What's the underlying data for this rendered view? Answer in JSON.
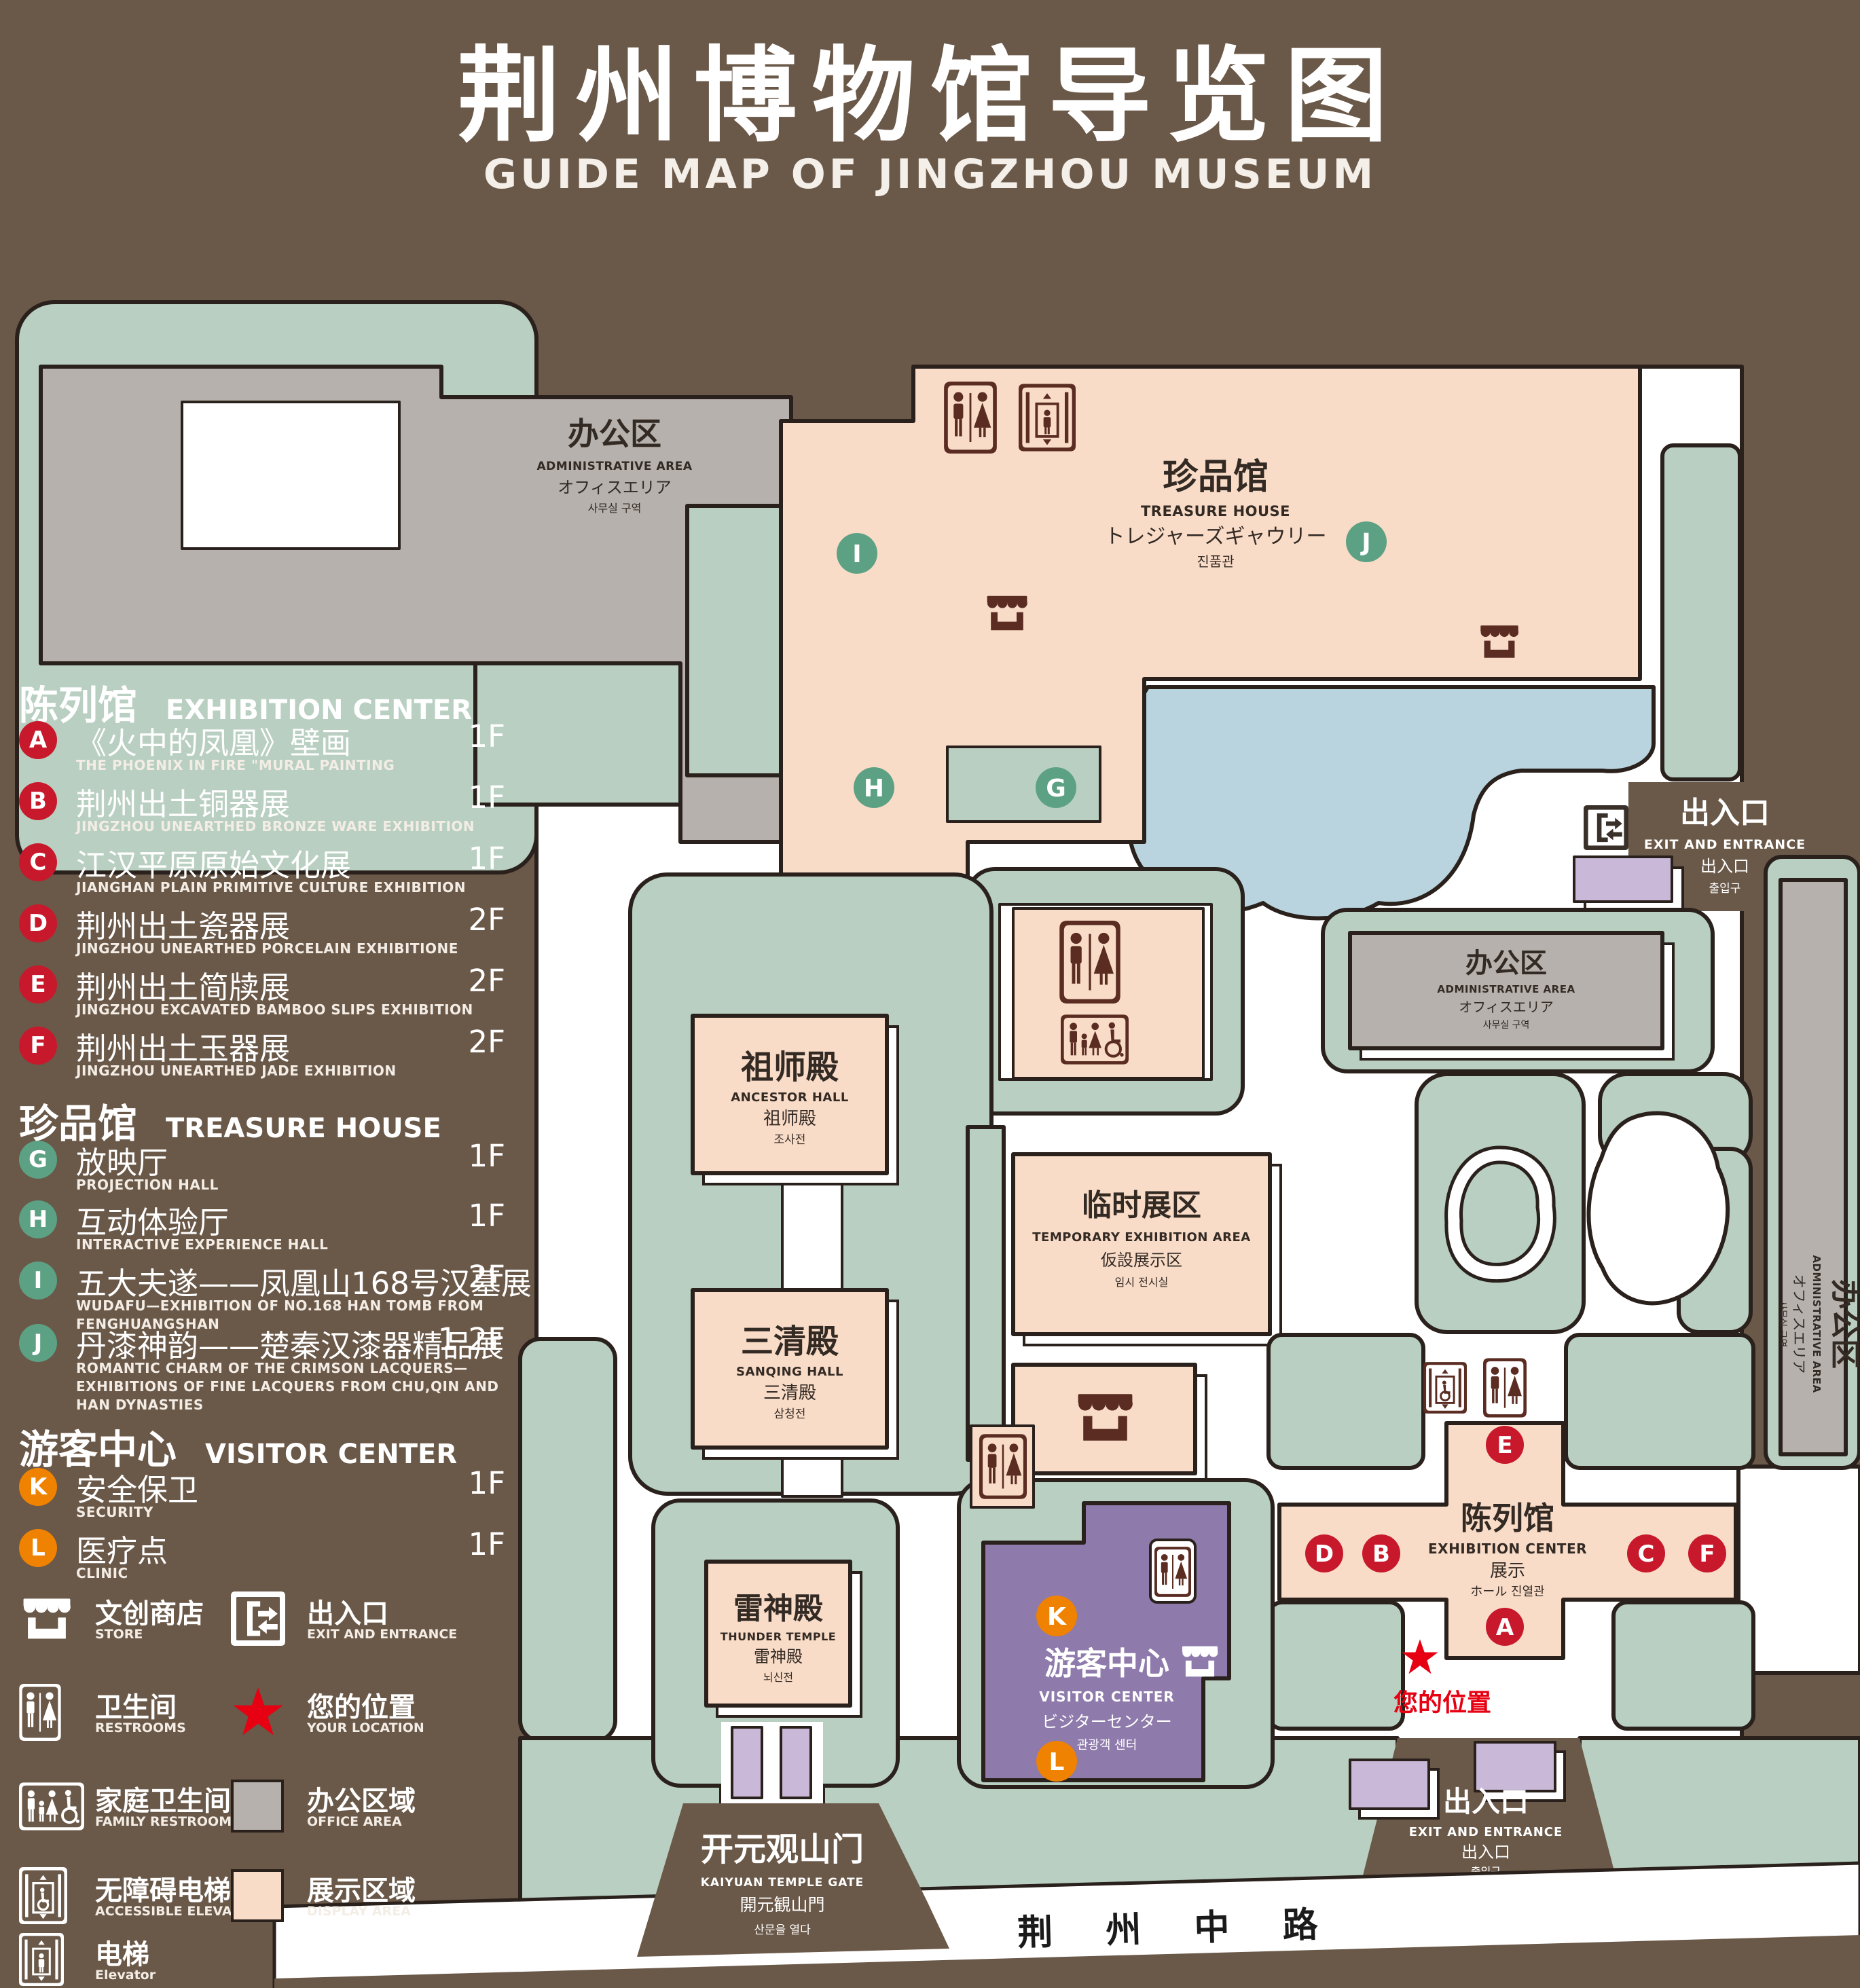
{
  "title": {
    "zh": "荆州博物馆导览图",
    "en": "GUIDE MAP OF JINGZHOU MUSEUM"
  },
  "colors": {
    "background": "#6a5848",
    "lawn": "#b8cfc1",
    "display_area": "#f9dcc8",
    "office_area": "#b6b1ad",
    "visitor_center": "#8e7aab",
    "small_building": "#c9b8d8",
    "lake": "#b9d4df",
    "badge_red": "#c8192c",
    "badge_green": "#5ca183",
    "badge_orange": "#ef8200",
    "icon_brown": "#5a2c22",
    "location_red": "#e60012",
    "outline": "#2a211c"
  },
  "legend": {
    "sections": [
      {
        "title_zh": "陈列馆",
        "title_en": "EXHIBITION CENTER",
        "items": [
          {
            "letter": "A",
            "zh": "《火中的凤凰》壁画",
            "en": "THE PHOENIX IN FIRE \"MURAL PAINTING",
            "floor": "1F"
          },
          {
            "letter": "B",
            "zh": "荆州出土铜器展",
            "en": "JINGZHOU UNEARTHED BRONZE WARE EXHIBITION",
            "floor": "1F"
          },
          {
            "letter": "C",
            "zh": "江汉平原原始文化展",
            "en": "JIANGHAN PLAIN PRIMITIVE CULTURE EXHIBITION",
            "floor": "1F"
          },
          {
            "letter": "D",
            "zh": "荆州出土瓷器展",
            "en": "JINGZHOU UNEARTHED PORCELAIN EXHIBITIONE",
            "floor": "2F"
          },
          {
            "letter": "E",
            "zh": "荆州出土简牍展",
            "en": "JINGZHOU EXCAVATED BAMBOO SLIPS EXHIBITION",
            "floor": "2F"
          },
          {
            "letter": "F",
            "zh": "荆州出土玉器展",
            "en": "JINGZHOU UNEARTHED JADE EXHIBITION",
            "floor": "2F"
          }
        ]
      },
      {
        "title_zh": "珍品馆",
        "title_en": "TREASURE HOUSE",
        "items": [
          {
            "letter": "G",
            "zh": "放映厅",
            "en": "PROJECTION HALL",
            "floor": "1F"
          },
          {
            "letter": "H",
            "zh": "互动体验厅",
            "en": "INTERACTIVE EXPERIENCE HALL",
            "floor": "1F"
          },
          {
            "letter": "I",
            "zh": "五大夫遂——凤凰山168号汉墓展",
            "en": "WUDAFU—EXHIBITION OF NO.168 HAN TOMB FROM FENGHUANGSHAN",
            "floor": "2F"
          },
          {
            "letter": "J",
            "zh": "丹漆神韵——楚秦汉漆器精品展",
            "en": "ROMANTIC CHARM OF THE CRIMSON LACQUERS—EXHIBITIONS OF FINE LACQUERS FROM CHU,QIN AND HAN DYNASTIES",
            "floor": "1-2F"
          }
        ]
      },
      {
        "title_zh": "游客中心",
        "title_en": "VISITOR CENTER",
        "items": [
          {
            "letter": "K",
            "zh": "安全保卫",
            "en": "SECURITY",
            "floor": "1F"
          },
          {
            "letter": "L",
            "zh": "医疗点",
            "en": "CLINIC",
            "floor": "1F"
          }
        ]
      }
    ],
    "symbols": [
      {
        "name": "store-icon",
        "zh": "文创商店",
        "en": "STORE"
      },
      {
        "name": "restroom-icon",
        "zh": "卫生间",
        "en": "RESTROOMS"
      },
      {
        "name": "family-restroom-icon",
        "zh": "家庭卫生间",
        "en": "FAMILY RESTROOMS"
      },
      {
        "name": "accessible-elevator-icon",
        "zh": "无障碍电梯",
        "en": "ACCESSIBLE ELEVATOR"
      },
      {
        "name": "elevator-icon",
        "zh": "电梯",
        "en": "Elevator"
      },
      {
        "name": "exit-entrance-icon",
        "zh": "出入口",
        "en": "EXIT AND ENTRANCE"
      },
      {
        "name": "your-location-star",
        "zh": "您的位置",
        "en": "YOUR LOCATION"
      },
      {
        "name": "office-area-swatch",
        "zh": "办公区域",
        "en": "OFFICE AREA"
      },
      {
        "name": "display-area-swatch",
        "zh": "展示区域",
        "en": "DISPLAY AREA"
      }
    ]
  },
  "map": {
    "buildings": {
      "admin_nw": {
        "zh": "办公区",
        "en": "ADMINISTRATIVE AREA",
        "ja": "オフィスエリア",
        "ko": "사무실 구역"
      },
      "treasure_house": {
        "zh": "珍品馆",
        "en": "TREASURE HOUSE",
        "ja": "トレジャーズギャウリー",
        "ko": "진품관"
      },
      "ancestor_hall": {
        "zh": "祖师殿",
        "en": "ANCESTOR HALL",
        "ja": "祖师殿",
        "ko": "조사전"
      },
      "sanqing_hall": {
        "zh": "三清殿",
        "en": "SANQING HALL",
        "ja": "三清殿",
        "ko": "삼청전"
      },
      "thunder_temple": {
        "zh": "雷神殿",
        "en": "THUNDER TEMPLE",
        "ja": "雷神殿",
        "ko": "뇌신전"
      },
      "temporary_exhibition": {
        "zh": "临时展区",
        "en": "TEMPORARY EXHIBITION AREA",
        "ja": "仮設展示区",
        "ko": "임시 전시실"
      },
      "admin_right": {
        "zh": "办公区",
        "en": "ADMINISTRATIVE AREA",
        "ja": "オフィスエリア",
        "ko": "사무실 구역"
      },
      "admin_far_right": {
        "zh": "办公区",
        "en": "ADMINISTRATIVE AREA",
        "ja": "オフィスエリア",
        "ko": "사무실 구역"
      },
      "visitor_center": {
        "zh": "游客中心",
        "en": "VISITOR CENTER",
        "ja": "ビジターセンター",
        "ko": "관광객 센터"
      },
      "exhibition_center": {
        "zh": "陈列馆",
        "en": "EXHIBITION CENTER",
        "l3": "展示",
        "l4": "ホール 진열관"
      }
    },
    "labels": {
      "exit_right": {
        "zh": "出入口",
        "en": "EXIT AND ENTRANCE",
        "zh_small": "出入口",
        "ko": "출입구"
      },
      "exit_bottom": {
        "zh": "出入口",
        "en": "EXIT AND ENTRANCE",
        "zh_small": "出入口",
        "ko": "출입구"
      },
      "gate": {
        "zh": "开元观山门",
        "en": "KAIYUAN TEMPLE GATE",
        "ja": "開元観山門",
        "ko": "산문을 열다"
      },
      "road": "荆 州 中 路",
      "your_location": "您的位置"
    },
    "badges": {
      "A": "A",
      "B": "B",
      "C": "C",
      "D": "D",
      "E": "E",
      "F": "F",
      "G": "G",
      "H": "H",
      "I": "I",
      "J": "J",
      "K": "K",
      "L": "L"
    }
  }
}
